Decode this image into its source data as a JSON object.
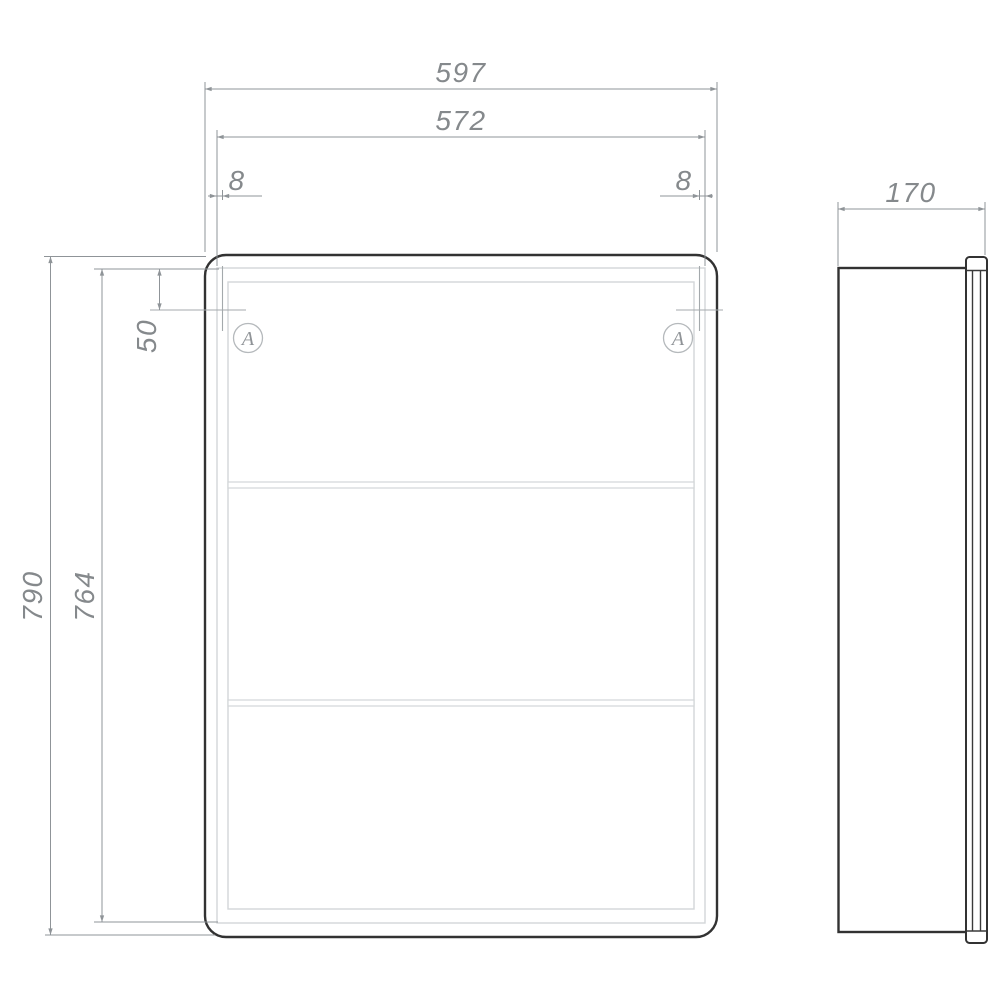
{
  "drawing": {
    "type": "technical-dimension-drawing",
    "subject": "mirror-cabinet",
    "views": {
      "front": "front view",
      "side": "side view"
    },
    "colors": {
      "background": "#ffffff",
      "outline": "#323232",
      "inner_line": "#d3d6d8",
      "dimension_line": "#8f9498",
      "dimension_text": "#85898c",
      "hinge_mark": "#a4a9ac",
      "callout": "#b5b9bc"
    },
    "dims": {
      "overall_width": "597",
      "door_width": "572",
      "hinge_inset_left": "8",
      "hinge_inset_right": "8",
      "hinge_top_offset": "50",
      "overall_height": "790",
      "door_height": "764",
      "depth": "170"
    },
    "callouts": {
      "left": "A",
      "right": "A"
    }
  }
}
